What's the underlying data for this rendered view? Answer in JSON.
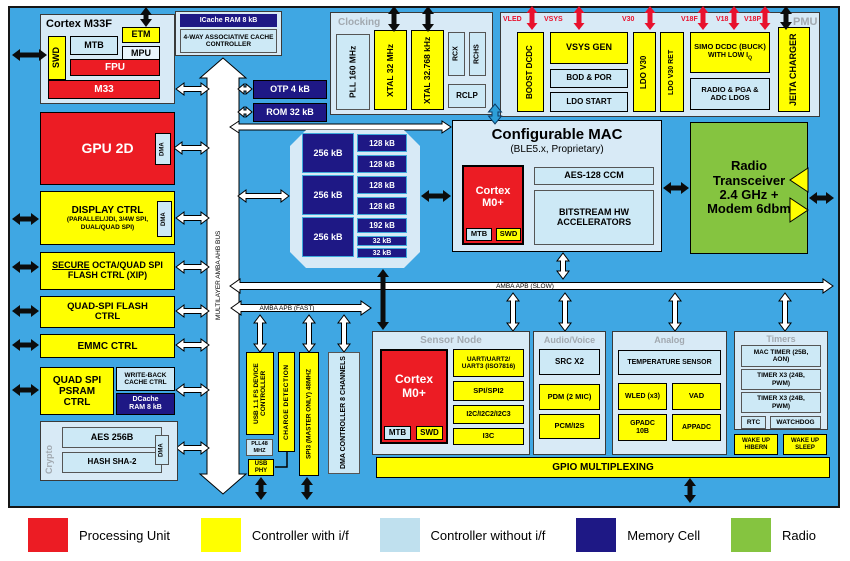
{
  "legend": {
    "items": [
      {
        "label": "Processing Unit",
        "color": "#EC1C24"
      },
      {
        "label": "Controller with i/f",
        "color": "#FFFF00"
      },
      {
        "label": "Controller without i/f",
        "color": "#BFE0EE"
      },
      {
        "label": "Memory Cell",
        "color": "#1E1885"
      },
      {
        "label": "Radio",
        "color": "#85C440"
      }
    ]
  },
  "buses": {
    "multilayer": "MULTILAYER AMBA AHB BUS",
    "apb_slow": "AMBA APB (SLOW)",
    "apb_fast": "AMBA APB (FAST)"
  },
  "cortex_m33f": {
    "title": "Cortex M33F",
    "etm": "ETM",
    "swd": "SWD",
    "mtb": "MTB",
    "mpu": "MPU",
    "fpu": "FPU",
    "m33": "M33"
  },
  "icache": {
    "ram": "ICache RAM 8 kB",
    "controller": "4-WAY ASSOCIATIVE CACHE CONTROLLER"
  },
  "left": {
    "gpu": "GPU 2D",
    "gpu_dma": "DMA",
    "display": "DISPLAY CTRL",
    "display_sub": "(PARALLEL/JDI, 3/4W SPI, DUAL/QUAD SPI)",
    "display_dma": "DMA",
    "secure_u": "SECURE",
    "secure_rest": " OCTA/QUAD SPI FLASH CTRL (XIP)",
    "quadspi": "QUAD-SPI FLASH CTRL",
    "emmc": "EMMC CTRL",
    "psram": "QUAD SPI PSRAM CTRL",
    "wbc": "WRITE-BACK CACHE CTRL",
    "dcache": "DCache RAM 8 kB"
  },
  "crypto": {
    "title": "Crypto",
    "aes": "AES 256B",
    "hash": "HASH SHA-2",
    "dma": "DMA"
  },
  "mem": {
    "otp": "OTP 4 kB",
    "rom": "ROM 32 kB",
    "col1": [
      "256 kB",
      "256 kB",
      "256 kB"
    ],
    "col2": [
      "128 kB",
      "128 kB",
      "128 kB",
      "128 kB",
      "192 kB",
      "32 kB",
      "32 kB"
    ]
  },
  "clocking": {
    "title": "Clocking",
    "pll": "PLL 160 MHz",
    "xtal1": "XTAL 32 MHz",
    "xtal2": "XTAL 32.768 kHz",
    "rcx": "RCX",
    "rchs": "RCHS",
    "rclp": "RCLP"
  },
  "pmu": {
    "title": "PMU",
    "rails": [
      "VLED",
      "VSYS",
      "V30",
      "V18F",
      "V18",
      "V18P"
    ],
    "boost": "BOOST DCDC",
    "vsys_gen": "VSYS GEN",
    "bod": "BOD & POR",
    "ldo_start": "LDO START",
    "ldo_v30": "LDO V30",
    "ldo_v30_ret": "LDO V30 RET",
    "simo1": "SIMO DCDC (BUCK)",
    "simo2": "WITH LOW I",
    "simo2_sub": "Q",
    "radio_ldos": "RADIO & PGA & ADC LDOS",
    "jeita": "JEITA CHARGER"
  },
  "mac": {
    "title": "Configurable MAC",
    "subtitle": "(BLE5.x, Proprietary)",
    "cortex": "Cortex M0+",
    "mtb": "MTB",
    "swd": "SWD",
    "aes": "AES-128 CCM",
    "bitstream": "BITSTREAM HW ACCELERATORS"
  },
  "radio": {
    "text": "Radio Transceiver 2.4 GHz + Modem 6dbm"
  },
  "sensor": {
    "title": "Sensor Node",
    "cortex": "Cortex M0+",
    "mtb": "MTB",
    "swd": "SWD",
    "uart": "UART/UART2/ UART3 (ISO7816)",
    "spi": "SPI/SPI2",
    "i2c": "I2C/I2C2/I2C3",
    "i3c": "I3C"
  },
  "audio": {
    "title": "Audio/Voice",
    "src": "SRC X2",
    "pdm": "PDM (2 MIC)",
    "pcm": "PCM/I2S"
  },
  "analog": {
    "title": "Analog",
    "temp": "TEMPERATURE SENSOR",
    "wled": "WLED (x3)",
    "vad": "VAD",
    "gpadc": "GPADC 10B",
    "appadc": "APPADC"
  },
  "timers": {
    "title": "Timers",
    "mac_timer": "MAC TIMER (25B, AON)",
    "timer_x3a": "TIMER X3 (24B, PWM)",
    "timer_x3b": "TIMER X3 (24B, PWM)",
    "rtc": "RTC",
    "watchdog": "WATCHDOG",
    "wake_hibern": "WAKE UP HIBERN",
    "wake_sleep": "WAKE UP SLEEP"
  },
  "usb": {
    "controller": "USB 1.1 FS DEVICE CONTROLLER",
    "pll48": "PLL48 MHZ",
    "phy": "USB PHY",
    "charge": "CHARGE DETECTION",
    "spi3": "SPI3 (MASTER ONLY) 48MHZ",
    "dma": "DMA CONTROLLER 8 CHANNELS"
  },
  "gpio": {
    "label": "GPIO MULTIPLEXING"
  }
}
